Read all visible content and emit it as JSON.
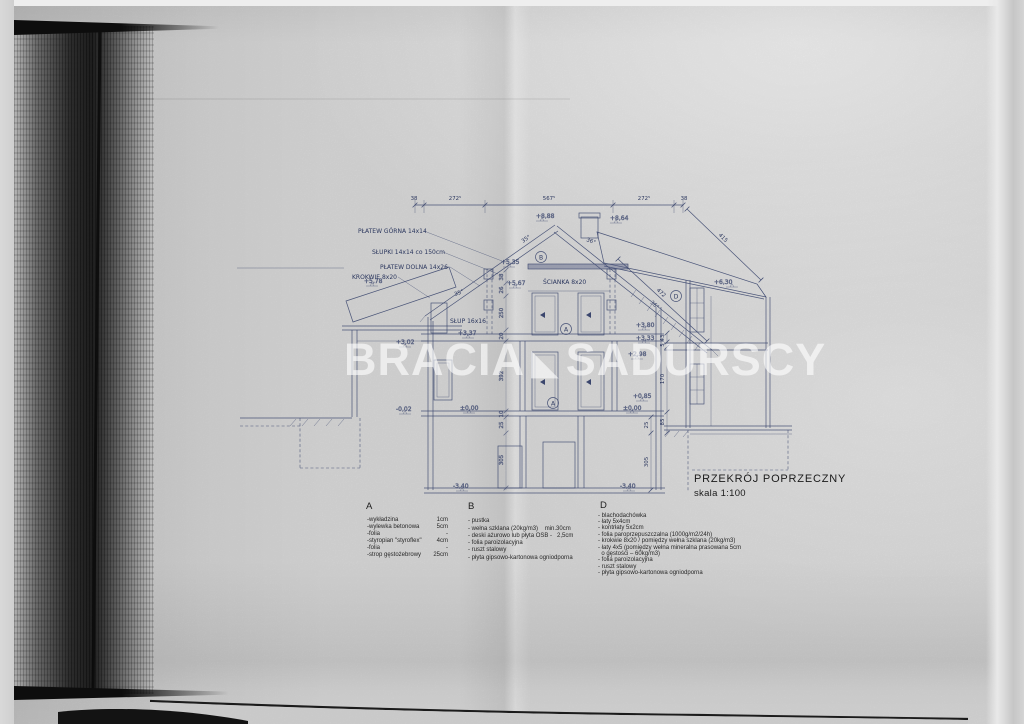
{
  "watermark": {
    "left": "BRACIA",
    "right": "SADURSCY",
    "triangle_icon": "◣"
  },
  "title_block": {
    "title": "PRZEKRÓJ POPRZECZNY",
    "scale": "skala 1:100"
  },
  "legend": {
    "a": {
      "header": "A",
      "items": [
        {
          "label": "-wykładzina",
          "value": "1cm"
        },
        {
          "label": "-wylewka betonowa",
          "value": "5cm"
        },
        {
          "label": "-folia",
          "value": "-"
        },
        {
          "label": "-styropian \"styroflex\"",
          "value": "4cm"
        },
        {
          "label": "-folia",
          "value": "-"
        },
        {
          "label": "-strop gęstożebrowy",
          "value": "25cm"
        }
      ]
    },
    "b": {
      "header": "B",
      "items": [
        "- pustka",
        "- wełna szklana (20kg/m3)    min.30cm",
        "- deski ażurowo lub płyta OSB -   2,5cm",
        "- folia paroizolacyjna",
        "- ruszt stalowy",
        "- płyta gipsowo-kartonowa ogniodporna"
      ]
    },
    "d": {
      "header": "D",
      "items": [
        "- blachodachówka",
        "- łaty 5x4cm",
        "- kontrłaty 5x2cm",
        "- folia paroprzepuszczalna (1000g/m2/24h)",
        "- krokwie 8x20 / pomiędzy wełna szklana (20kg/m3)",
        "- łaty 4x5 (pomiędzy wełna mineralna prasowana 5cm",
        "  o gęstości – 60kg/m3)",
        "- folia paroizolacyjna",
        "- ruszt stalowy",
        "- płyta gipsowo-kartonowa ogniodporna"
      ]
    }
  },
  "drawing": {
    "labels": {
      "platew_gorna": "PŁATEW GÓRNA 14x14",
      "slupki": "SŁUPKI 14x14 co 150cm",
      "platew_dolna": "PŁATEW DOLNA 14x26",
      "krokwie": "KROKWIE 8x20",
      "slup": "SŁUP 16x16",
      "scianka": "ŚCIANKA 8x20"
    },
    "elevations": {
      "e888": "+8,88",
      "e864": "+8,64",
      "e630": "+6,30",
      "e578": "+5,78",
      "e535": "+5,35",
      "e567": "+5,67",
      "e380": "+3,80",
      "e337": "+3,37",
      "e333": "+3,33",
      "e302": "+3,02",
      "e298": "+2,98",
      "e085": "+0,85",
      "e000_left": "±0,00",
      "e000_right": "±0,00",
      "em002": "-0,02",
      "em340_left": "-3,40",
      "em340_right": "-3,40"
    },
    "markers": {
      "b": "B",
      "a_upper": "A",
      "a_lower": "A",
      "d": "D"
    },
    "dims": {
      "top": [
        "38",
        "272⁵",
        "567⁵",
        "272⁵",
        "38"
      ],
      "slope_right": "415",
      "slope_section": "472",
      "angle_left_upper": "35°",
      "angle_left_lower": "35°",
      "angle_right_upper": "36°",
      "angle_right_lower": "36°",
      "chain_center": [
        "38",
        "26",
        "250",
        "20",
        "392",
        "10",
        "25",
        "305"
      ],
      "chain_right": [
        "43",
        "5",
        "170",
        "85"
      ],
      "chain_right_basement": [
        "25",
        "305"
      ]
    }
  }
}
